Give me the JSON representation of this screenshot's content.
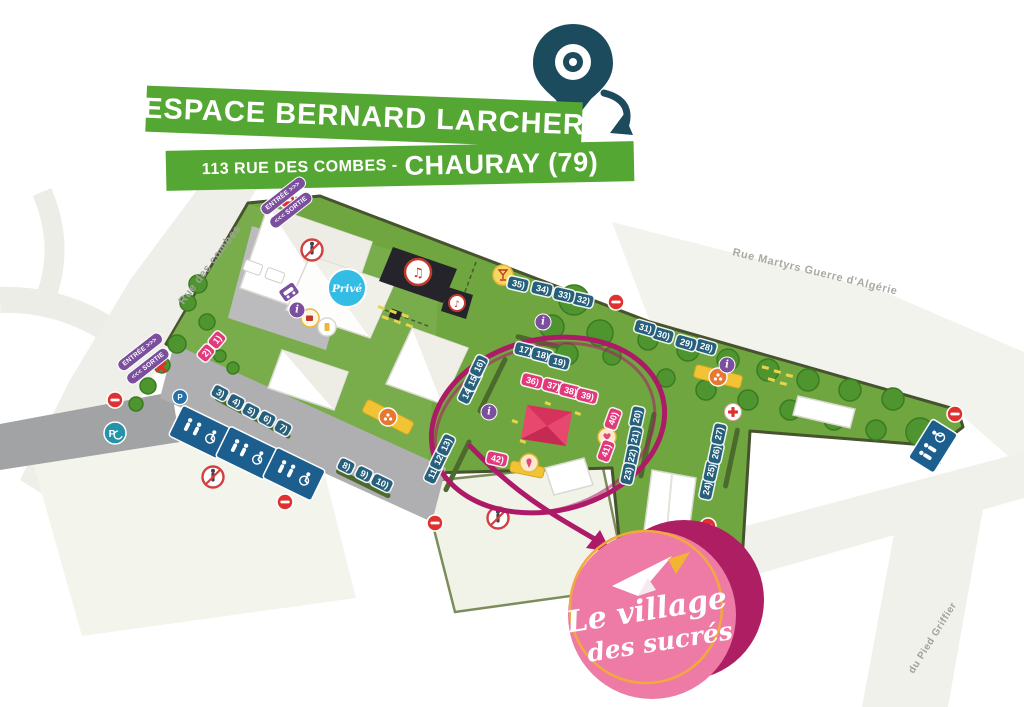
{
  "header": {
    "title": "ESPACE BERNARD LARCHER",
    "address_prefix": "113 RUE DES COMBES -",
    "address_city": "CHAURAY (79)"
  },
  "event_badge": {
    "line1": "Le village",
    "line2": "des sucrés"
  },
  "streets": {
    "left": "Rue des combes",
    "top_right": "Rue Martyrs Guerre d'Algérie",
    "bottom_right": "du Pied Griffier"
  },
  "map": {
    "entrance_label": "ENTRÉE >>>",
    "exit_label": "<<< SORTIE",
    "private_label": "Privé",
    "parking_label": "P",
    "info_label": "i",
    "stands": [
      {
        "label": "1)",
        "x": 217,
        "y": 340,
        "rot": -50,
        "c": "pink"
      },
      {
        "label": "2)",
        "x": 206,
        "y": 353,
        "rot": -50,
        "c": "pink"
      },
      {
        "label": "3)",
        "x": 220,
        "y": 393,
        "rot": 28,
        "c": "blue"
      },
      {
        "label": "4)",
        "x": 236,
        "y": 402,
        "rot": 28,
        "c": "blue"
      },
      {
        "label": "5)",
        "x": 251,
        "y": 411,
        "rot": 28,
        "c": "blue"
      },
      {
        "label": "6)",
        "x": 267,
        "y": 419,
        "rot": 28,
        "c": "blue"
      },
      {
        "label": "7)",
        "x": 283,
        "y": 428,
        "rot": 28,
        "c": "blue"
      },
      {
        "label": "8)",
        "x": 346,
        "y": 466,
        "rot": 26,
        "c": "blue"
      },
      {
        "label": "9)",
        "x": 364,
        "y": 474,
        "rot": 26,
        "c": "blue"
      },
      {
        "label": "10)",
        "x": 382,
        "y": 483,
        "rot": 26,
        "c": "blue"
      },
      {
        "label": "11)",
        "x": 433,
        "y": 473,
        "rot": -64,
        "c": "blue"
      },
      {
        "label": "12)",
        "x": 439,
        "y": 459,
        "rot": -64,
        "c": "blue"
      },
      {
        "label": "13)",
        "x": 446,
        "y": 445,
        "rot": -64,
        "c": "blue"
      },
      {
        "label": "14)",
        "x": 467,
        "y": 393,
        "rot": -64,
        "c": "blue"
      },
      {
        "label": "15)",
        "x": 473,
        "y": 380,
        "rot": -64,
        "c": "blue"
      },
      {
        "label": "16)",
        "x": 479,
        "y": 366,
        "rot": -64,
        "c": "blue"
      },
      {
        "label": "17)",
        "x": 525,
        "y": 350,
        "rot": 14,
        "c": "blue"
      },
      {
        "label": "18)",
        "x": 542,
        "y": 355,
        "rot": 14,
        "c": "blue"
      },
      {
        "label": "19)",
        "x": 559,
        "y": 362,
        "rot": 14,
        "c": "blue"
      },
      {
        "label": "20)",
        "x": 637,
        "y": 417,
        "rot": -78,
        "c": "blue"
      },
      {
        "label": "21)",
        "x": 635,
        "y": 437,
        "rot": -78,
        "c": "blue"
      },
      {
        "label": "22)",
        "x": 632,
        "y": 456,
        "rot": -78,
        "c": "blue"
      },
      {
        "label": "23)",
        "x": 628,
        "y": 474,
        "rot": -78,
        "c": "blue"
      },
      {
        "label": "24)",
        "x": 707,
        "y": 489,
        "rot": -78,
        "c": "blue"
      },
      {
        "label": "25)",
        "x": 711,
        "y": 471,
        "rot": -78,
        "c": "blue"
      },
      {
        "label": "26)",
        "x": 716,
        "y": 453,
        "rot": -78,
        "c": "blue"
      },
      {
        "label": "27)",
        "x": 719,
        "y": 434,
        "rot": -78,
        "c": "blue"
      },
      {
        "label": "28)",
        "x": 706,
        "y": 347,
        "rot": 16,
        "c": "blue"
      },
      {
        "label": "29)",
        "x": 686,
        "y": 343,
        "rot": 16,
        "c": "blue"
      },
      {
        "label": "30)",
        "x": 663,
        "y": 335,
        "rot": 16,
        "c": "blue"
      },
      {
        "label": "31)",
        "x": 645,
        "y": 328,
        "rot": 16,
        "c": "blue"
      },
      {
        "label": "32)",
        "x": 583,
        "y": 300,
        "rot": 13,
        "c": "blue"
      },
      {
        "label": "33)",
        "x": 564,
        "y": 295,
        "rot": 13,
        "c": "blue"
      },
      {
        "label": "34)",
        "x": 542,
        "y": 289,
        "rot": 13,
        "c": "blue"
      },
      {
        "label": "35)",
        "x": 518,
        "y": 284,
        "rot": 13,
        "c": "blue"
      },
      {
        "label": "36)",
        "x": 532,
        "y": 381,
        "rot": 14,
        "c": "pink"
      },
      {
        "label": "37)",
        "x": 553,
        "y": 386,
        "rot": 14,
        "c": "pink"
      },
      {
        "label": "38)",
        "x": 570,
        "y": 391,
        "rot": 14,
        "c": "pink"
      },
      {
        "label": "39)",
        "x": 587,
        "y": 396,
        "rot": 14,
        "c": "pink"
      },
      {
        "label": "40)",
        "x": 613,
        "y": 419,
        "rot": -70,
        "c": "pink"
      },
      {
        "label": "41)",
        "x": 606,
        "y": 451,
        "rot": -70,
        "c": "pink"
      },
      {
        "label": "42)",
        "x": 497,
        "y": 459,
        "rot": 12,
        "c": "pink"
      }
    ],
    "info_points": [
      {
        "label": "i",
        "x": 297,
        "y": 310
      },
      {
        "label": "i",
        "x": 543,
        "y": 322
      },
      {
        "label": "i",
        "x": 727,
        "y": 365
      },
      {
        "label": "i",
        "x": 489,
        "y": 412
      }
    ]
  },
  "colors": {
    "banner_green": "#55A733",
    "field_green": "#6FA63F",
    "stand_blue": "#26607C",
    "stand_pink": "#E2397B",
    "highlight_magenta": "#AD1A67",
    "badge_pink": "#EE7BA6",
    "badge_dark_pink": "#AE1E63",
    "badge_ring_orange": "#F2A93B",
    "pin_teal": "#1D4B5E",
    "purple": "#7B4E9E"
  }
}
